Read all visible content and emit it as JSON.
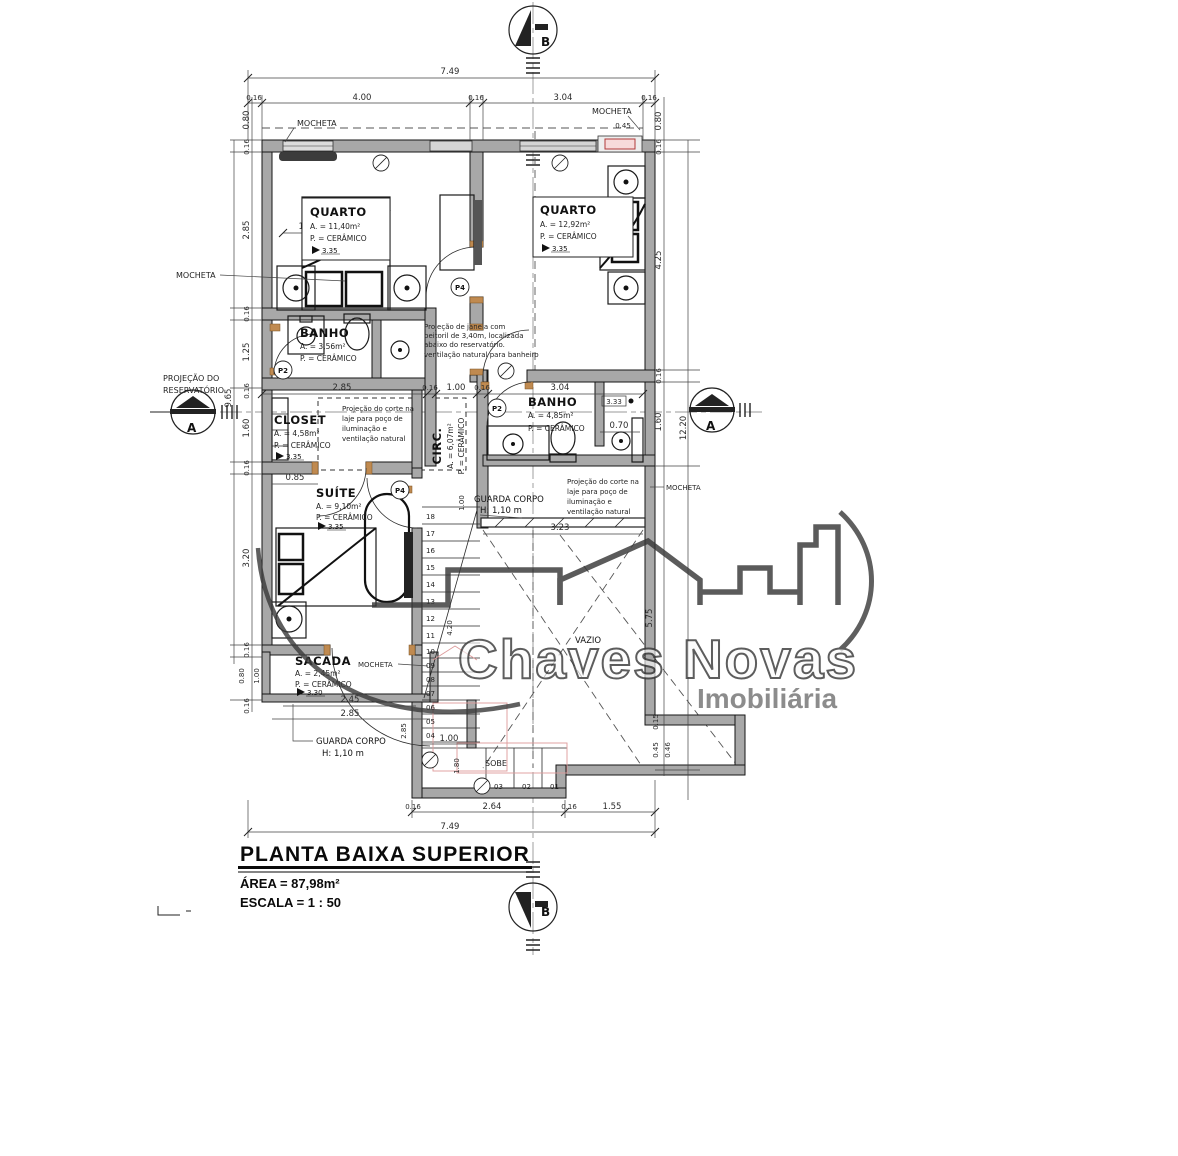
{
  "title_block": {
    "title": "PLANTA BAIXA SUPERIOR",
    "area": "ÁREA = 87,98m²",
    "scale": "ESCALA = 1 : 50"
  },
  "watermark": {
    "brand": "Chaves Novas",
    "tagline": "Imobiliária"
  },
  "rooms": {
    "quarto1": {
      "name": "QUARTO",
      "area": "A. = 11,40m²",
      "floor": "P. = CERÂMICO",
      "level": "3.35"
    },
    "quarto2": {
      "name": "QUARTO",
      "area": "A. = 12,92m²",
      "floor": "P. = CERÂMICO",
      "level": "3.35"
    },
    "banho1": {
      "name": "BANHO",
      "area": "A. = 3,56m²",
      "floor": "P. = CERÂMICO"
    },
    "closet": {
      "name": "CLOSET",
      "area": "A. = 4,58m²",
      "floor": "P. = CERÂMICO",
      "level": "3.35"
    },
    "circ": {
      "name": "CIRC.",
      "area": "A. = 6,07m²",
      "floor": "P. = CERÂMICO"
    },
    "banho2": {
      "name": "BANHO",
      "area": "A. = 4,85m²",
      "floor": "P. = CERÂMICO",
      "level": "3.33"
    },
    "suite": {
      "name": "SUÍTE",
      "area": "A. = 9,10m²",
      "floor": "P. = CERÂMICO",
      "level": "3.35"
    },
    "sacada": {
      "name": "SACADA",
      "area": "A. = 2,45m²",
      "floor": "P. = CERÂMICO",
      "level": "3.30"
    }
  },
  "annotations": {
    "mocheta": "MOCHETA",
    "reservatorio": [
      "PROJEÇÃO DO",
      "RESERVATÓRIO"
    ],
    "janela_note": [
      "Projeção de janela com",
      "peitoril de 3,40m, localizada",
      "abaixo do reservatório.",
      "ventilação natural para banheiro"
    ],
    "corte_note": [
      "Projeção do corte na",
      "laje para poço de",
      "iluminação e",
      "ventilação natural"
    ],
    "guarda_corpo": [
      "GUARDA CORPO",
      "H: 1,10 m"
    ],
    "vazio": "VAZIO",
    "sobe": "SOBE"
  },
  "dims": {
    "top": [
      "7.49",
      "0.16",
      "4.00",
      "0.16",
      "3.04",
      "0.16"
    ],
    "bottom": [
      "0.16",
      "2.64",
      "0.16",
      "1.55",
      "7.49"
    ],
    "left": [
      "0.80",
      "0.16",
      "2.85",
      "0.16",
      "1.25",
      "0.16",
      "9.65",
      "1.60",
      "0.16",
      "3.20",
      "0.16",
      "0.80",
      "1.00",
      "0.16"
    ],
    "right": [
      "0.45",
      "0.80",
      "0.16",
      "4.25",
      "0.16",
      "1.60",
      "12.20",
      "5.75",
      "0.15",
      "0.45",
      "0.46"
    ],
    "interior": [
      "1.40",
      "2.85",
      "0.16",
      "1.00",
      "0.16",
      "3.04",
      "0.70",
      "0.85",
      "3.23",
      "2.45",
      "2.85",
      "1.00",
      "1.80",
      "4.20",
      "1.00",
      "2.85",
      "3.33"
    ]
  },
  "stairs": {
    "numbers": [
      "01",
      "02",
      "03",
      "04",
      "05",
      "06",
      "07",
      "08",
      "09",
      "10",
      "11",
      "12",
      "13",
      "14",
      "15",
      "16",
      "17",
      "18"
    ]
  },
  "markers": {
    "section_a": "A",
    "section_b": "B",
    "door1": "P2",
    "door2": "P2",
    "door3": "P4",
    "door4": "P4"
  }
}
